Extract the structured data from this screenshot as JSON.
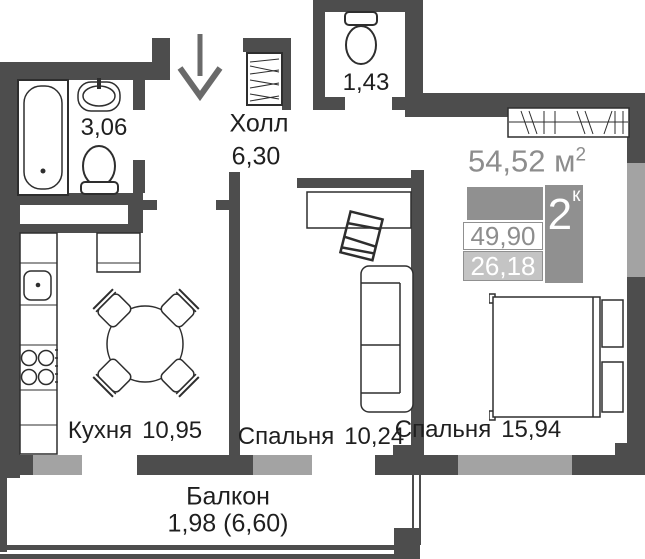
{
  "summary": {
    "total_area": "54,52",
    "total_unit": "м",
    "total_sup": "2",
    "rooms_count": "2",
    "rooms_suffix": "к",
    "area_living": "49,90",
    "area_kitchen_living": "26,18"
  },
  "rooms": [
    {
      "id": "bathroom",
      "name": "",
      "area": "3,06"
    },
    {
      "id": "hall",
      "name": "Холл",
      "area": "6,30"
    },
    {
      "id": "wc",
      "name": "",
      "area": "1,43"
    },
    {
      "id": "kitchen",
      "name": "Кухня",
      "area": "10,95"
    },
    {
      "id": "bedroom-small",
      "name": "Спальня",
      "area": "10,24"
    },
    {
      "id": "bedroom-big",
      "name": "Спальня",
      "area": "15,94"
    },
    {
      "id": "balcony",
      "name": "Балкон",
      "area": "1,98 (6,60)"
    }
  ],
  "icons": {
    "entrance_arrow": "down-arrow",
    "bathtub": "bathtub",
    "sink": "sink",
    "toilet": "toilet",
    "wardrobe": "hatched-wardrobe",
    "stove": "4-burner-stove",
    "dining_table": "round-table",
    "sofa": "sofa",
    "bed": "double-bed"
  },
  "colors": {
    "wall": "#4d4d4d",
    "window": "#a3a3a3",
    "arrow": "#6a6a6a",
    "badge_gray": "#909090",
    "badge_light": "#c4c4c4",
    "text_dark": "#1f1f1f",
    "area_text": "#8d8d8d",
    "furniture_stroke": "#2e2e2e"
  }
}
